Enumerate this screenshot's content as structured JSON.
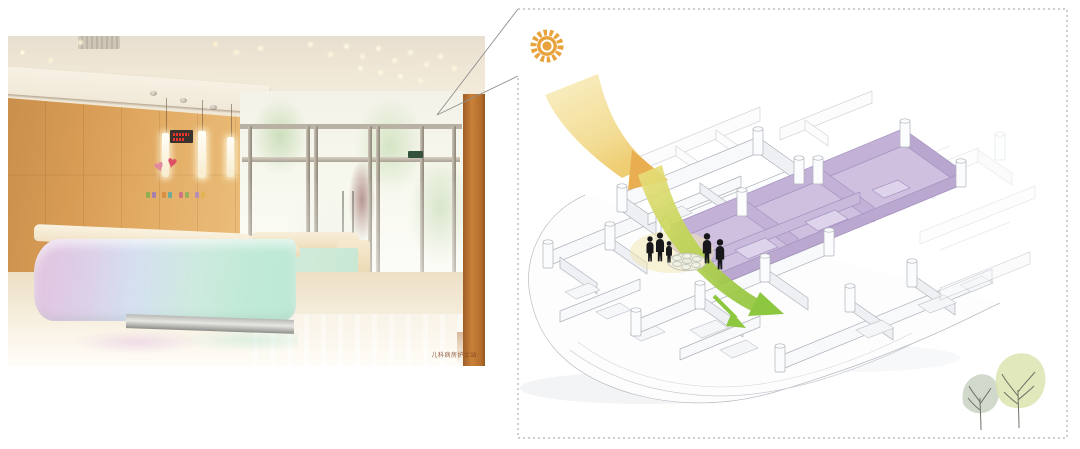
{
  "page": {
    "description": "Children's ward lobby photo with axonometric daylight and circulation diagram"
  },
  "photo": {
    "watermark": "儿科病房护士站",
    "heart_glyph": "♥"
  },
  "diagram": {
    "colors": {
      "sun": "#E8A33C",
      "sunbeam_light": "#FAF0C6",
      "sunbeam_deep": "#E9AE4F",
      "circulation_green": "#8DC63F",
      "highlight_zone_purple": "#CFC0DF",
      "tree_left": "#C9D2C4",
      "tree_right": "#DDE5B2"
    },
    "figures_count": 5,
    "trees_count": 2
  }
}
